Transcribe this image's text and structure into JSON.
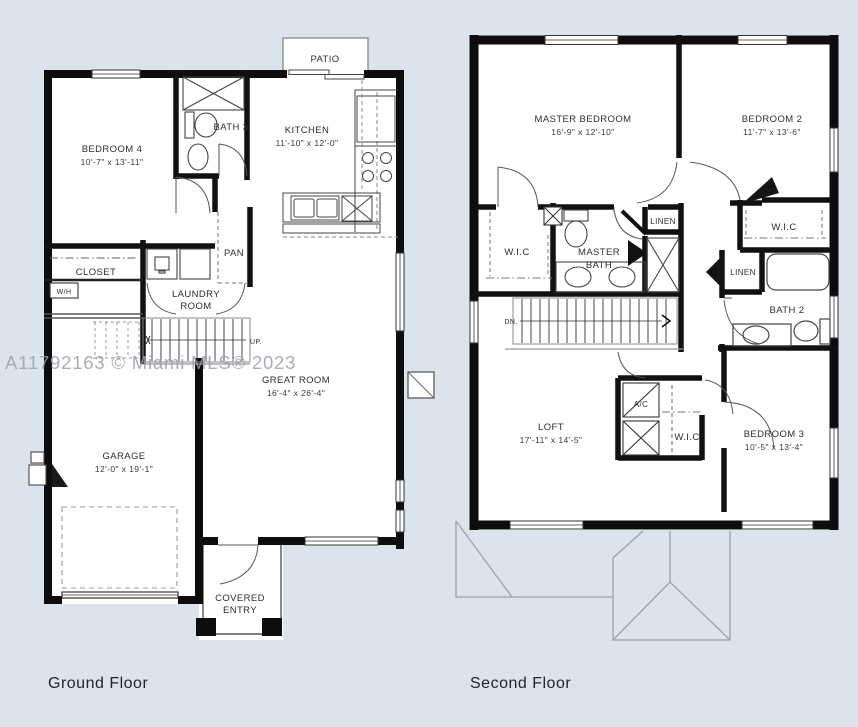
{
  "background_color": "#dbe3ec",
  "watermark": "A11792163 © Miami MLS® 2023",
  "ground_floor": {
    "title": "Ground Floor",
    "labels": {
      "patio": "PATIO",
      "bath3": "BATH 3",
      "kitchen": "KITCHEN",
      "kitchen_dims": "11'-10\" x 12'-0\"",
      "bedroom4": "BEDROOM 4",
      "bedroom4_dims": "10'-7\" x 13'-11\"",
      "pan": "PAN",
      "closet": "CLOSET",
      "wh": "W/H",
      "laundry_line1": "LAUNDRY",
      "laundry_line2": "ROOM",
      "up": "UP.",
      "great_room": "GREAT ROOM",
      "great_room_dims": "16'-4\" x 26'-4\"",
      "garage": "GARAGE",
      "garage_dims": "12'-0\" x 19'-1\"",
      "covered_line1": "COVERED",
      "covered_line2": "ENTRY"
    }
  },
  "second_floor": {
    "title": "Second Floor",
    "labels": {
      "master_bedroom": "MASTER BEDROOM",
      "master_bedroom_dims": "16'-9\" x 12'-10\"",
      "bedroom2": "BEDROOM 2",
      "bedroom2_dims": "11'-7\" x 13'-6\"",
      "wic_master": "W.I.C",
      "master_bath_line1": "MASTER",
      "master_bath_line2": "BATH",
      "linen_hall": "LINEN",
      "wic_bedroom2": "W.I.C",
      "linen_bath2": "LINEN",
      "bath2": "BATH 2",
      "dn": "DN.",
      "loft": "LOFT",
      "loft_dims": "17'-11\" x 14'-5\"",
      "ac": "A/C",
      "wic_bedroom3": "W.I.C",
      "bedroom3": "BEDROOM 3",
      "bedroom3_dims": "10'-5\" x 13'-4\""
    }
  }
}
